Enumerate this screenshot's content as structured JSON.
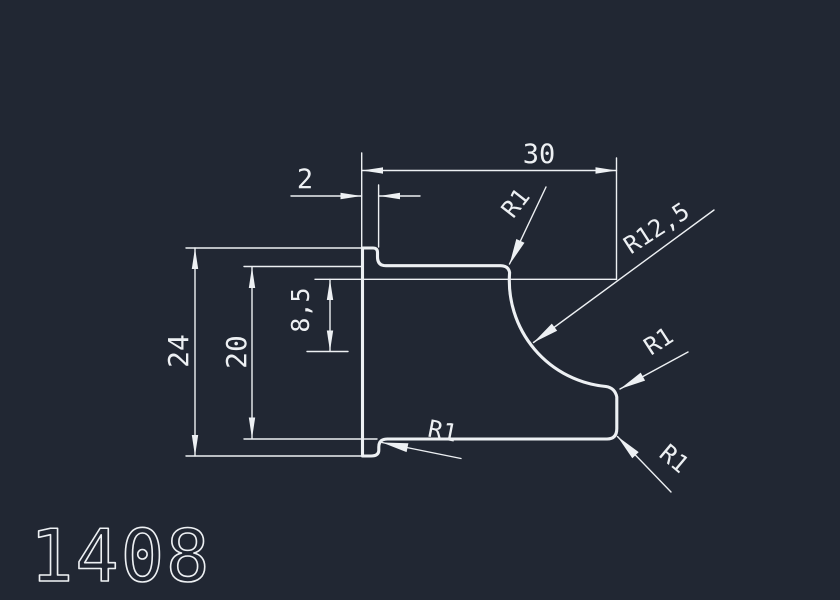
{
  "canvas": {
    "background_color": "#212733",
    "line_color": "#edf0f3"
  },
  "part_number": {
    "value": "1408"
  },
  "dimensions": {
    "top_width": {
      "value": "30"
    },
    "flange_width": {
      "value": "2"
    },
    "overall_height": {
      "value": "24"
    },
    "body_height": {
      "value": "20"
    },
    "cove_center_offset": {
      "value": "8,5"
    }
  },
  "radii": {
    "top_fillet": {
      "value": "R1"
    },
    "cove": {
      "value": "R12,5"
    },
    "right_upper_fillet": {
      "value": "R1"
    },
    "right_lower_fillet": {
      "value": "R1"
    },
    "bottom_left_fillet": {
      "value": "R1"
    }
  }
}
